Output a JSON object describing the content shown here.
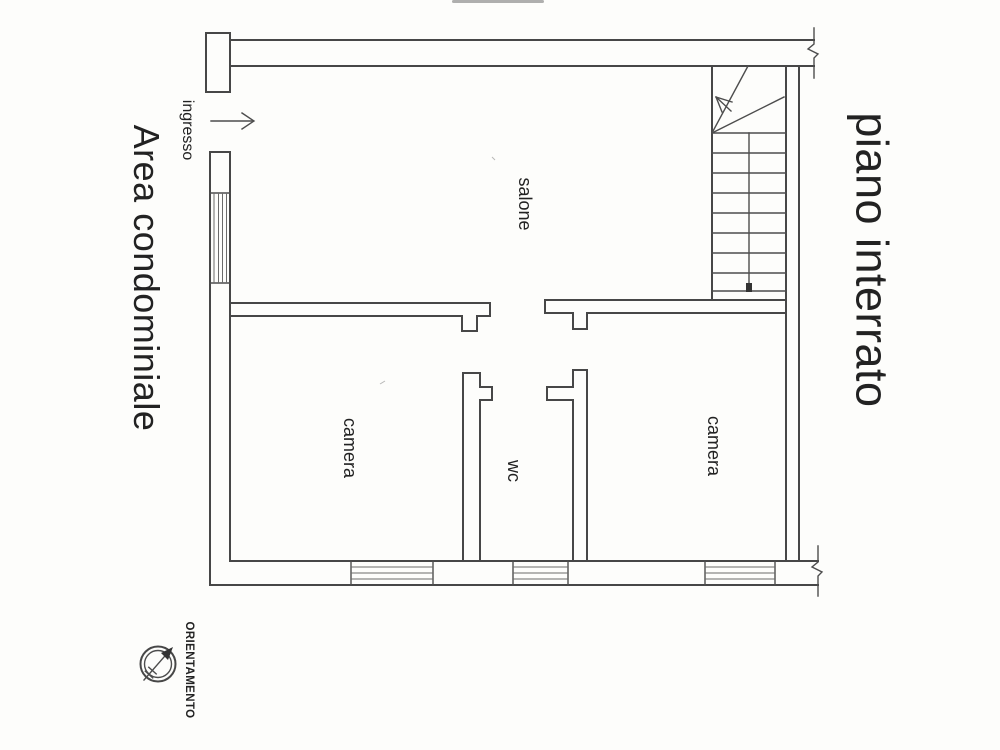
{
  "plan": {
    "title": "piano interrato",
    "exterior_label": "Area condominiale",
    "entrance_label": "ingresso",
    "rooms": {
      "salone": "salone",
      "camera_left": "camera",
      "wc": "wc",
      "camera_right": "camera"
    },
    "compass": {
      "label": "ORIENTAMENTO"
    },
    "colors": {
      "line": "#474747",
      "text": "#222222",
      "paper": "#fdfdfb"
    }
  }
}
